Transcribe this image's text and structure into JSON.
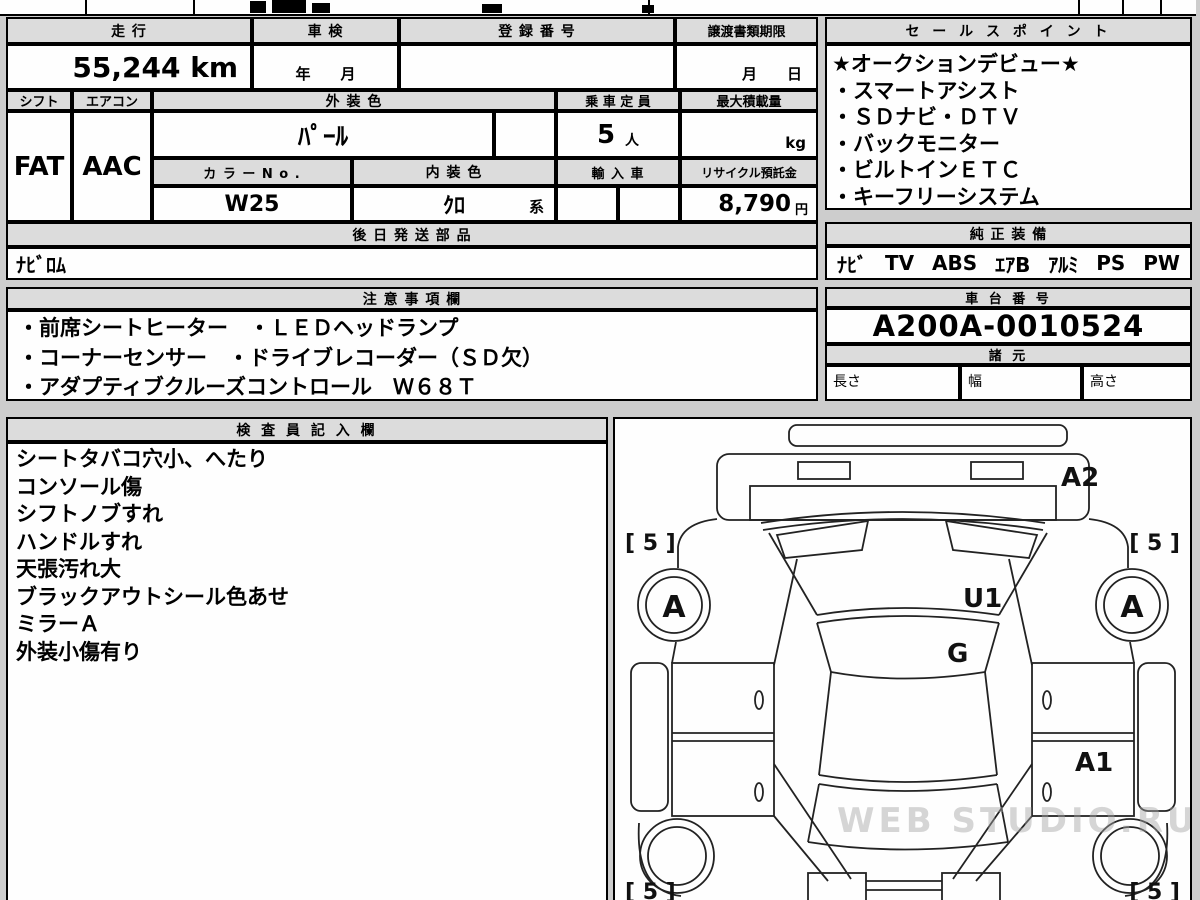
{
  "colors": {
    "page_bg": "#cdcdcd",
    "header_bg": "#dcdcdc",
    "cell_bg": "#ffffff",
    "border": "#000000"
  },
  "main_table": {
    "mileage_label": "走 行",
    "mileage_value": "55,244 km",
    "inspection_label": "車 検",
    "inspection_placeholder": "年　　月",
    "registration_label": "登 録 番 号",
    "transfer_label": "譲渡書類期限",
    "transfer_placeholder": "月　　日",
    "shift_label": "シフト",
    "shift_value": "FAT",
    "aircon_label": "エアコン",
    "aircon_value": "AAC",
    "exterior_color_label": "外 装 色",
    "exterior_color_value": "ﾊﾟｰﾙ",
    "color_no_label": "カ ラ ー N o .",
    "color_no_value": "W25",
    "interior_color_label": "内 装 色",
    "interior_color_value": "ｸﾛ",
    "interior_color_suffix": "系",
    "capacity_label": "乗 車 定 員",
    "capacity_value": "5",
    "capacity_unit": "人",
    "max_load_label": "最大積載量",
    "max_load_unit": "kg",
    "import_label": "輸 入 車",
    "recycle_label": "リサイクル預託金",
    "recycle_value": "8,790",
    "recycle_unit": "円",
    "later_parts_label": "後 日 発 送 部 品",
    "later_parts_value": "ﾅﾋﾞﾛﾑ"
  },
  "sales_points": {
    "title": "セ ー ル ス ポ イ ン ト",
    "items": [
      "★オークションデビュー★",
      "・スマートアシスト",
      "・ＳＤナビ・ＤＴＶ",
      "・バックモニター",
      "・ビルトインＥＴＣ",
      "・キーフリーシステム"
    ]
  },
  "equipment": {
    "title": "純 正 装 備",
    "items": [
      "ﾅﾋﾞ",
      "TV",
      "ABS",
      "ｴｱB",
      "ｱﾙﾐ",
      "PS",
      "PW"
    ]
  },
  "notes": {
    "title": "注 意 事 項 欄",
    "lines": [
      "・前席シートヒーター　・ＬＥＤヘッドランプ",
      "・コーナーセンサー　・ドライブレコーダー（ＳＤ欠）",
      "・アダプティブクルーズコントロール　Ｗ６８Ｔ"
    ]
  },
  "chassis": {
    "title": "車 台 番 号",
    "number": "A200A-0010524",
    "specs_title": "諸 元",
    "length_label": "長さ",
    "width_label": "幅",
    "height_label": "高さ"
  },
  "inspector": {
    "title": "検 査 員 記 入 欄",
    "lines": [
      "シートタバコ穴小、へたり",
      "コンソール傷",
      "シフトノブすれ",
      "ハンドルすれ",
      "天張汚れ大",
      "ブラックアウトシール色あせ",
      "ミラーＡ",
      "外装小傷有り"
    ]
  },
  "diagram": {
    "label_a2": "A2",
    "label_u1": "U1",
    "label_g": "G",
    "label_a1": "A1",
    "label_wheel_front_left": "A",
    "label_wheel_front_right": "A",
    "tread_top_left": "[ 5 ]",
    "tread_top_right": "[ 5 ]",
    "tread_bottom_left": "[ 5 ]",
    "tread_bottom_right": "[ 5 ]",
    "watermark": "WEB STUDIO.RU"
  }
}
